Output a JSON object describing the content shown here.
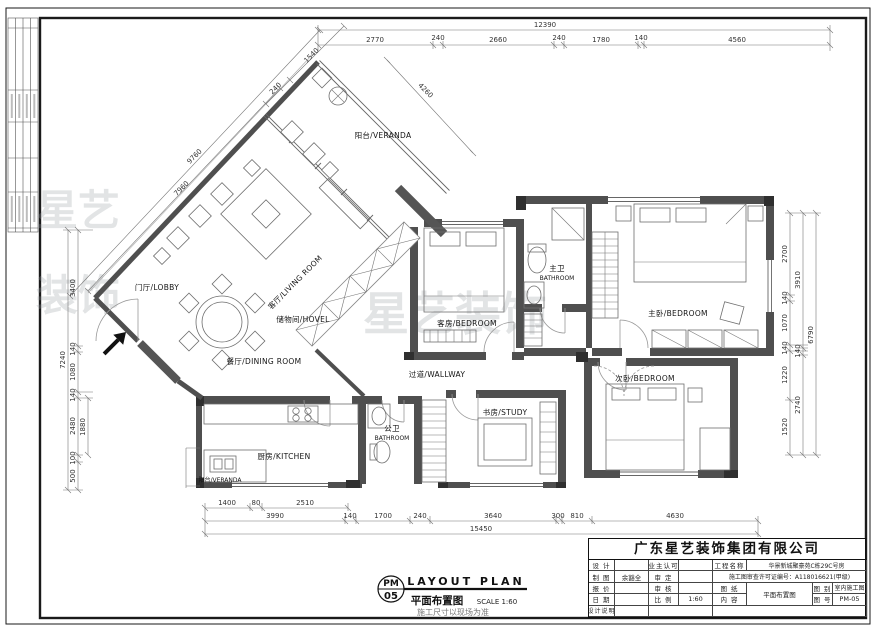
{
  "watermark": {
    "main": "星艺装饰",
    "side_a": "星艺",
    "side_b": "装饰"
  },
  "rooms": {
    "veranda_top": "阳台/VERANDA",
    "living": "客厅/LIVING ROOM",
    "lobby": "门厅/LOBBY",
    "dining": "餐厅/DINING ROOM",
    "storage": "储物间/HOVEL",
    "guest": "客房/BEDROOM",
    "master_bath_zh": "主卫",
    "master_bath_en": "BATHROOM",
    "master": "主卧/BEDROOM",
    "hallway": "过道/WALLWAY",
    "second": "次卧/BEDROOM",
    "study": "书房/STUDY",
    "public_bath_zh": "公卫",
    "public_bath_en": "BATHROOM",
    "kitchen": "厨房/KITCHEN",
    "veranda_bottom": "阳台/VERANDA"
  },
  "dims": {
    "top_total": "12390",
    "top": [
      "2770",
      "240",
      "2660",
      "240",
      "1780",
      "140",
      "4560"
    ],
    "top_diag": [
      "240",
      "1540"
    ],
    "veranda_diag": "4260",
    "nw_diag": [
      "9760",
      "7960"
    ],
    "left_total": "7240",
    "left": [
      "3400",
      "140",
      "1080",
      "140",
      "2480",
      "100",
      "500"
    ],
    "left_inner": "1880",
    "right_a": [
      "2700",
      "140",
      "1070",
      "140",
      "1220",
      "1520"
    ],
    "right_b": [
      "3910",
      "140",
      "2740"
    ],
    "right_c": "6790",
    "bottom_r1": [
      "1400",
      "80",
      "2510"
    ],
    "bottom_r2": [
      "3990",
      "140",
      "1700",
      "240",
      "3640",
      "300",
      "810",
      "4630"
    ],
    "bottom_total": "15450"
  },
  "title_block": {
    "company": "广东星艺装饰集团有限公司",
    "labels": {
      "design": "设 计",
      "owner": "业主认可",
      "project": "工程名称",
      "draft": "制 图",
      "approve": "审 定",
      "quote": "报 价",
      "check": "审 核",
      "sheet": "图 纸",
      "type": "图 别",
      "date": "日 期",
      "scale": "比 例",
      "content": "内 容",
      "no": "图 号",
      "note": "设计说明"
    },
    "values": {
      "draft": "余豁全",
      "scale": "1:60",
      "project": "华景新城聚豪苑C栋29C号房",
      "permit": "施工图审查许可证编号：A118016621(甲级)",
      "content": "平面布置图",
      "type": "室内施工图",
      "no": "PM-05"
    }
  },
  "drawing_label": {
    "code_top": "PM",
    "code_bottom": "05",
    "title_en": "LAYOUT PLAN",
    "title_zh": "平面布置图",
    "scale": "SCALE 1:60",
    "note": "施工尺寸以现场为准"
  }
}
